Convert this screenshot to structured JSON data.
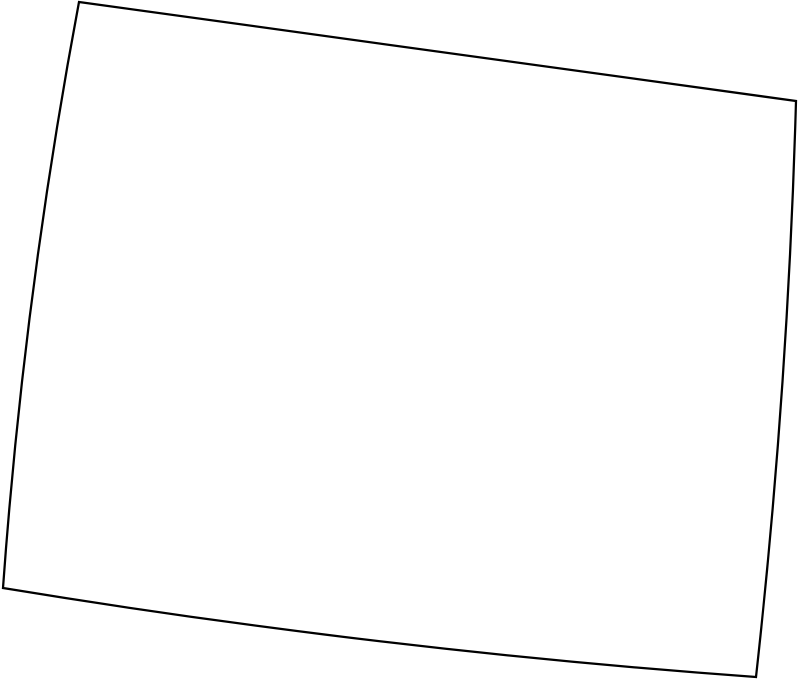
{
  "map": {
    "region": "Wyoming",
    "kind": "state-outline-map",
    "canvas": {
      "width": 800,
      "height": 683
    },
    "outline": {
      "path": "M 79,2 L 796,101 Q 788,389 756,677 Q 380,650 3,588 Q 24,295 79,2 Z",
      "stroke_color": "#000000",
      "fill_color": "#ffffff",
      "stroke_width": "2.25"
    },
    "corners": {
      "top_left": [
        79,
        2
      ],
      "top_right": [
        796,
        101
      ],
      "bottom_right": [
        756,
        677
      ],
      "bottom_left": [
        3,
        588
      ]
    }
  }
}
